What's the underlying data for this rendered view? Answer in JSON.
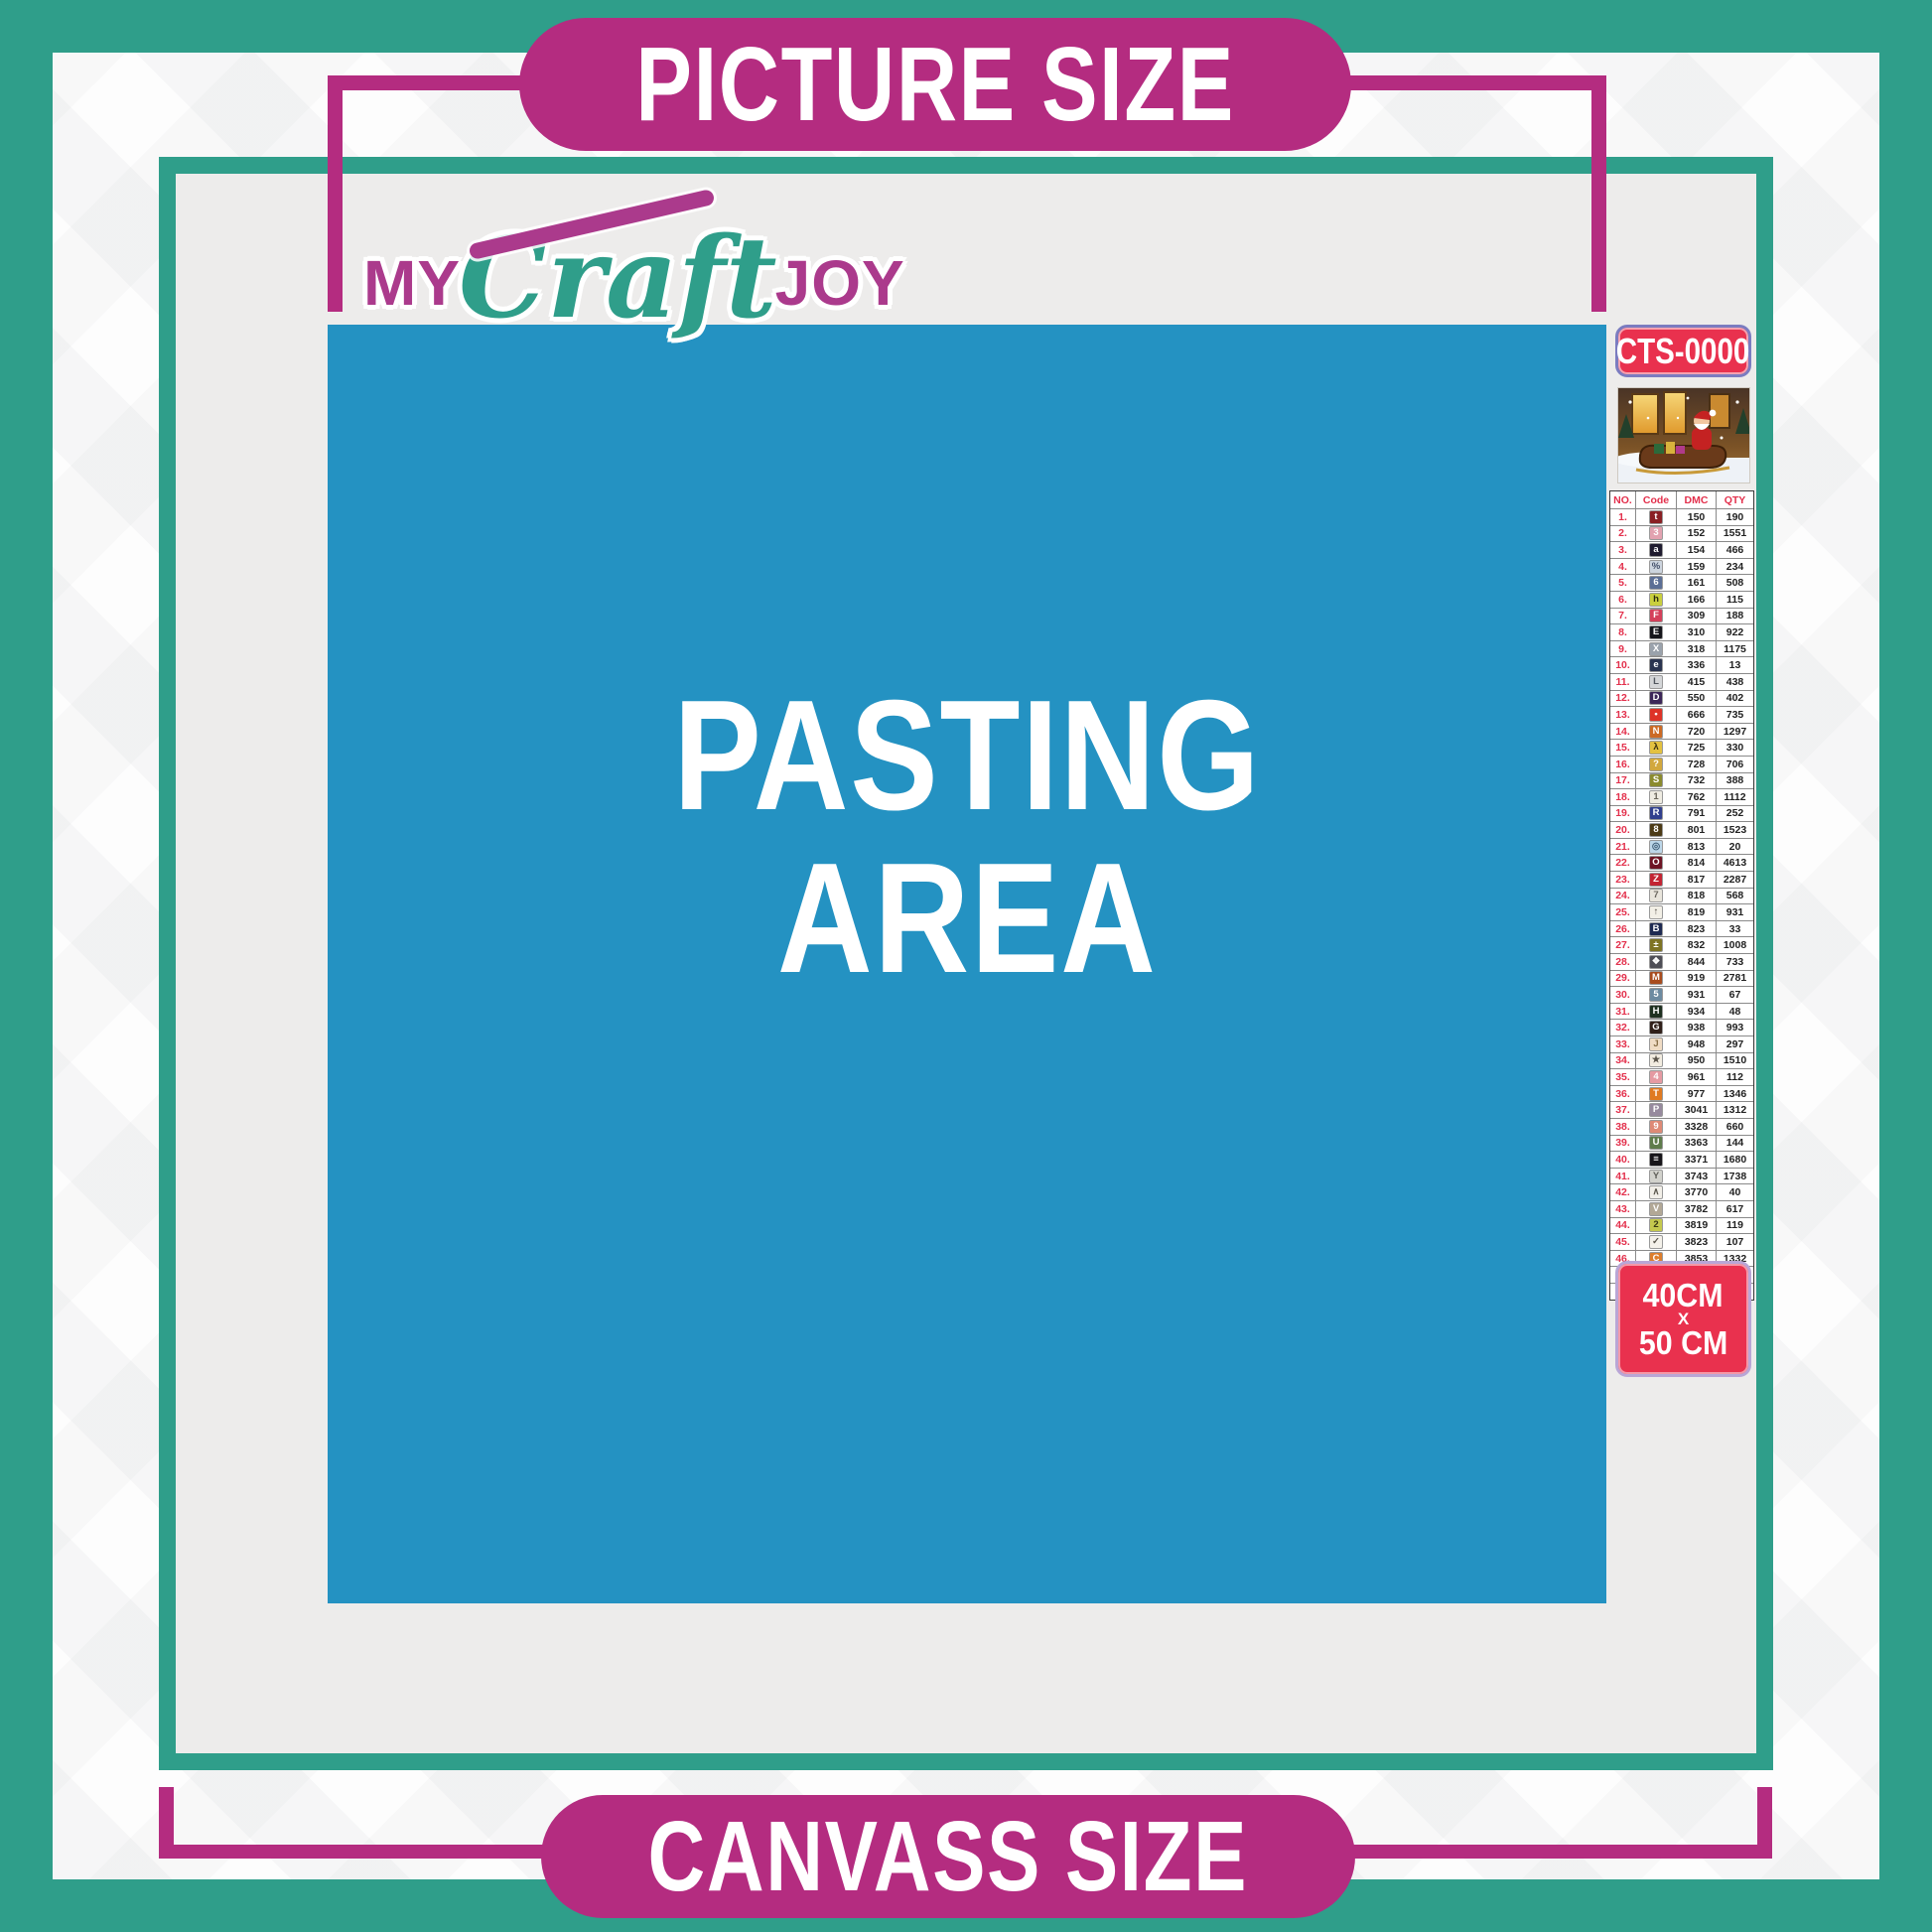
{
  "banners": {
    "top_label": "PICTURE SIZE",
    "bottom_label": "CANVASS SIZE"
  },
  "logo": {
    "word1": "MY",
    "word2": "Craft",
    "word3": "JOY"
  },
  "pasting": {
    "line1": "PASTING",
    "line2": "AREA"
  },
  "sku": {
    "code": "CTS-0000"
  },
  "size_label": {
    "line1": "40CM",
    "line2": "X",
    "line3": "50 CM"
  },
  "thumbnail": {
    "name": "christmas-santa-sleigh-artwork"
  },
  "legend": {
    "headers": {
      "no": "NO.",
      "code": "Code",
      "dmc": "DMC",
      "qty": "QTY"
    },
    "rows": [
      {
        "no": "1.",
        "sym": "t",
        "bg": "#8a2024",
        "fg": "#ffffff",
        "dmc": "150",
        "qty": "190"
      },
      {
        "no": "2.",
        "sym": "3",
        "bg": "#e2a2b0",
        "fg": "#ffffff",
        "dmc": "152",
        "qty": "1551"
      },
      {
        "no": "3.",
        "sym": "a",
        "bg": "#201c30",
        "fg": "#ffffff",
        "dmc": "154",
        "qty": "466"
      },
      {
        "no": "4.",
        "sym": "%",
        "bg": "#ccd4de",
        "fg": "#44506a",
        "dmc": "159",
        "qty": "234"
      },
      {
        "no": "5.",
        "sym": "6",
        "bg": "#5c6f96",
        "fg": "#ffffff",
        "dmc": "161",
        "qty": "508"
      },
      {
        "no": "6.",
        "sym": "h",
        "bg": "#c9cf3e",
        "fg": "#2a2a10",
        "dmc": "166",
        "qty": "115"
      },
      {
        "no": "7.",
        "sym": "F",
        "bg": "#d4405a",
        "fg": "#ffffff",
        "dmc": "309",
        "qty": "188"
      },
      {
        "no": "8.",
        "sym": "E",
        "bg": "#15151b",
        "fg": "#ffffff",
        "dmc": "310",
        "qty": "922"
      },
      {
        "no": "9.",
        "sym": "X",
        "bg": "#9aa2ac",
        "fg": "#ffffff",
        "dmc": "318",
        "qty": "1175"
      },
      {
        "no": "10.",
        "sym": "e",
        "bg": "#2a3450",
        "fg": "#ffffff",
        "dmc": "336",
        "qty": "13"
      },
      {
        "no": "11.",
        "sym": "L",
        "bg": "#d4d6d8",
        "fg": "#50565e",
        "dmc": "415",
        "qty": "438"
      },
      {
        "no": "12.",
        "sym": "D",
        "bg": "#3c2658",
        "fg": "#ffffff",
        "dmc": "550",
        "qty": "402"
      },
      {
        "no": "13.",
        "sym": "•",
        "bg": "#de3328",
        "fg": "#ffffff",
        "dmc": "666",
        "qty": "735"
      },
      {
        "no": "14.",
        "sym": "N",
        "bg": "#cc6a24",
        "fg": "#ffffff",
        "dmc": "720",
        "qty": "1297"
      },
      {
        "no": "15.",
        "sym": "λ",
        "bg": "#e3c140",
        "fg": "#3a3010",
        "dmc": "725",
        "qty": "330"
      },
      {
        "no": "16.",
        "sym": "?",
        "bg": "#d2a83e",
        "fg": "#ffffff",
        "dmc": "728",
        "qty": "706"
      },
      {
        "no": "17.",
        "sym": "S",
        "bg": "#8b8b2e",
        "fg": "#ffffff",
        "dmc": "732",
        "qty": "388"
      },
      {
        "no": "18.",
        "sym": "1",
        "bg": "#efece2",
        "fg": "#6a665a",
        "dmc": "762",
        "qty": "1112"
      },
      {
        "no": "19.",
        "sym": "R",
        "bg": "#31408e",
        "fg": "#ffffff",
        "dmc": "791",
        "qty": "252"
      },
      {
        "no": "20.",
        "sym": "8",
        "bg": "#4c3b16",
        "fg": "#ffffff",
        "dmc": "801",
        "qty": "1523"
      },
      {
        "no": "21.",
        "sym": "◎",
        "bg": "#bcd6e8",
        "fg": "#3a5a74",
        "dmc": "813",
        "qty": "20"
      },
      {
        "no": "22.",
        "sym": "O",
        "bg": "#6e1424",
        "fg": "#ffffff",
        "dmc": "814",
        "qty": "4613"
      },
      {
        "no": "23.",
        "sym": "Z",
        "bg": "#c32433",
        "fg": "#ffffff",
        "dmc": "817",
        "qty": "2287"
      },
      {
        "no": "24.",
        "sym": "7",
        "bg": "#e9e5dc",
        "fg": "#6a665e",
        "dmc": "818",
        "qty": "568"
      },
      {
        "no": "25.",
        "sym": "↑",
        "bg": "#f2efe6",
        "fg": "#5a564e",
        "dmc": "819",
        "qty": "931"
      },
      {
        "no": "26.",
        "sym": "B",
        "bg": "#1e2a52",
        "fg": "#ffffff",
        "dmc": "823",
        "qty": "33"
      },
      {
        "no": "27.",
        "sym": "±",
        "bg": "#7e7424",
        "fg": "#ffffff",
        "dmc": "832",
        "qty": "1008"
      },
      {
        "no": "28.",
        "sym": "❖",
        "bg": "#4e4e56",
        "fg": "#ffffff",
        "dmc": "844",
        "qty": "733"
      },
      {
        "no": "29.",
        "sym": "M",
        "bg": "#a84c1e",
        "fg": "#ffffff",
        "dmc": "919",
        "qty": "2781"
      },
      {
        "no": "30.",
        "sym": "5",
        "bg": "#6d8ba1",
        "fg": "#ffffff",
        "dmc": "931",
        "qty": "67"
      },
      {
        "no": "31.",
        "sym": "H",
        "bg": "#1e3020",
        "fg": "#ffffff",
        "dmc": "934",
        "qty": "48"
      },
      {
        "no": "32.",
        "sym": "G",
        "bg": "#30201a",
        "fg": "#ffffff",
        "dmc": "938",
        "qty": "993"
      },
      {
        "no": "33.",
        "sym": "J",
        "bg": "#f0dcc4",
        "fg": "#8a7048",
        "dmc": "948",
        "qty": "297"
      },
      {
        "no": "34.",
        "sym": "★",
        "bg": "#f2ece0",
        "fg": "#5a544a",
        "dmc": "950",
        "qty": "1510"
      },
      {
        "no": "35.",
        "sym": "4",
        "bg": "#e59aa2",
        "fg": "#ffffff",
        "dmc": "961",
        "qty": "112"
      },
      {
        "no": "36.",
        "sym": "T",
        "bg": "#e07a22",
        "fg": "#ffffff",
        "dmc": "977",
        "qty": "1346"
      },
      {
        "no": "37.",
        "sym": "P",
        "bg": "#978a9e",
        "fg": "#ffffff",
        "dmc": "3041",
        "qty": "1312"
      },
      {
        "no": "38.",
        "sym": "9",
        "bg": "#de8a76",
        "fg": "#ffffff",
        "dmc": "3328",
        "qty": "660"
      },
      {
        "no": "39.",
        "sym": "U",
        "bg": "#5f7c4c",
        "fg": "#ffffff",
        "dmc": "3363",
        "qty": "144"
      },
      {
        "no": "40.",
        "sym": "≡",
        "bg": "#17151a",
        "fg": "#ffffff",
        "dmc": "3371",
        "qty": "1680"
      },
      {
        "no": "41.",
        "sym": "Y",
        "bg": "#d2d2cc",
        "fg": "#5e5e58",
        "dmc": "3743",
        "qty": "1738"
      },
      {
        "no": "42.",
        "sym": "∧",
        "bg": "#f2efe8",
        "fg": "#5c584e",
        "dmc": "3770",
        "qty": "40"
      },
      {
        "no": "43.",
        "sym": "V",
        "bg": "#b2a896",
        "fg": "#ffffff",
        "dmc": "3782",
        "qty": "617"
      },
      {
        "no": "44.",
        "sym": "2",
        "bg": "#c5c94e",
        "fg": "#3a3a14",
        "dmc": "3819",
        "qty": "119"
      },
      {
        "no": "45.",
        "sym": "✓",
        "bg": "#f4f1ea",
        "fg": "#5a564c",
        "dmc": "3823",
        "qty": "107"
      },
      {
        "no": "46.",
        "sym": "C",
        "bg": "#dd7e2c",
        "fg": "#ffffff",
        "dmc": "3853",
        "qty": "1332"
      },
      {
        "no": "47.",
        "sym": "K",
        "bg": "#7c4a38",
        "fg": "#ffffff",
        "dmc": "3858",
        "qty": "2311"
      },
      {
        "no": "48.",
        "sym": "A",
        "bg": "#b0a494",
        "fg": "#ffffff",
        "dmc": "3863",
        "qty": "1820"
      }
    ]
  },
  "colors": {
    "teal": "#2f9e8a",
    "magenta": "#b42c80",
    "red": "#e9314e",
    "blue": "#2492c2",
    "gray": "#edeceb"
  }
}
